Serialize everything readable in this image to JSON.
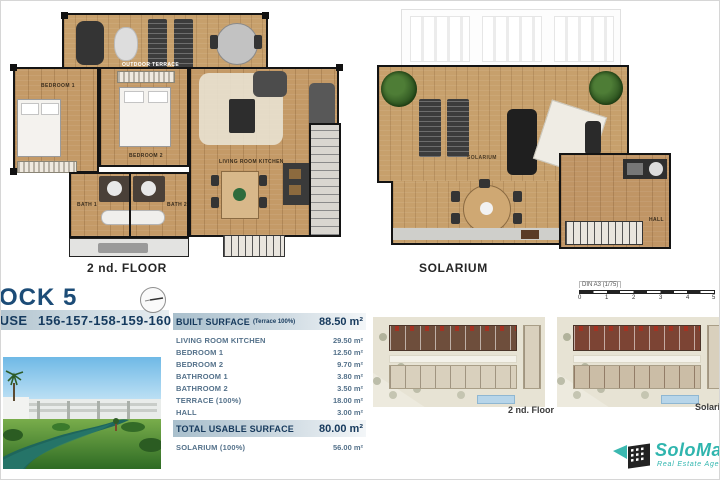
{
  "header": {
    "block_title": "BLOCK 5",
    "unit_type": "PENTHOUSE",
    "unit_numbers": "156-157-158-159-160"
  },
  "plans": {
    "floor_label": "2 nd. FLOOR",
    "solarium_label": "SOLARIUM",
    "rooms": {
      "outdoor_terrace": "OUTDOOR TERRACE",
      "bedroom1": "BEDROOM 1",
      "bedroom2": "BEDROOM 2",
      "living": "LIVING ROOM KITCHEN",
      "bath1": "BATH 1",
      "bath2": "BATH 2",
      "solarium_small": "SOLARIUM",
      "hall": "HALL"
    }
  },
  "surface_table": {
    "built_header": {
      "label": "BUILT SURFACE",
      "note": "(Terrace 100%)",
      "value": "88.50 m²"
    },
    "rows": [
      {
        "label": "LIVING ROOM KITCHEN",
        "value": "29.50 m²"
      },
      {
        "label": "BEDROOM 1",
        "value": "12.50 m²"
      },
      {
        "label": "BEDROOM 2",
        "value": "9.70 m²"
      },
      {
        "label": "BATHROOM 1",
        "value": "3.80 m²"
      },
      {
        "label": "BATHROOM 2",
        "value": "3.50 m²"
      },
      {
        "label": "TERRACE (100%)",
        "value": "18.00 m²"
      },
      {
        "label": "HALL",
        "value": "3.00 m²"
      }
    ],
    "total_header": {
      "label": "TOTAL USABLE SURFACE",
      "value": "80.00 m²"
    },
    "solarium_row": {
      "label": "SOLARIUM (100%)",
      "value": "56.00 m²"
    }
  },
  "site_plans": [
    {
      "label": "2 nd. Floor"
    },
    {
      "label": "Solarium"
    }
  ],
  "scale": {
    "label": "DIN A3 (1/75)",
    "ticks": [
      "0",
      "1",
      "2",
      "3",
      "4",
      "5"
    ]
  },
  "logo": {
    "name": "SoloMar",
    "tagline": "Real Estate Agency"
  },
  "colors": {
    "accent_navy": "#16456e",
    "table_text": "#54718a",
    "logo_teal": "#2fb5ae",
    "header_bar": "#b5c6d0"
  }
}
